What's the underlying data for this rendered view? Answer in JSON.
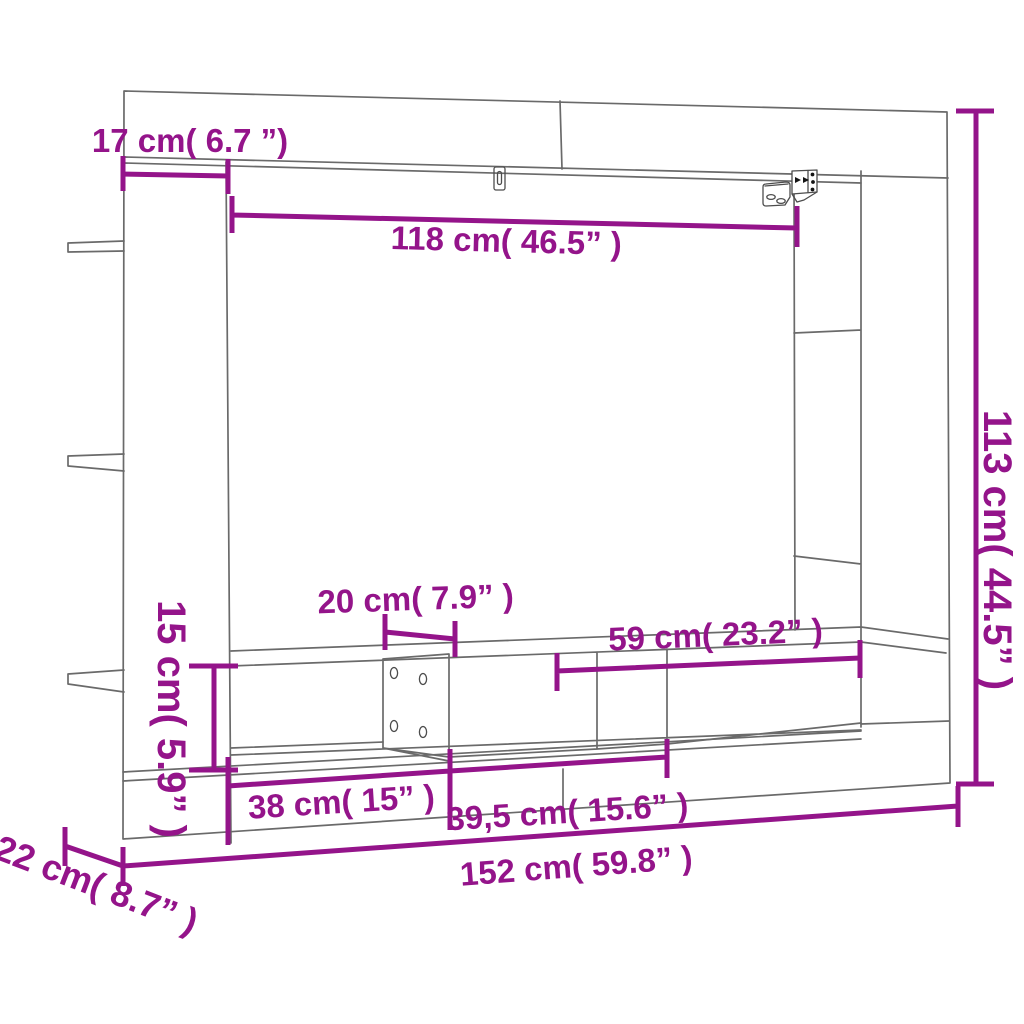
{
  "diagram": {
    "type": "furniture-dimension-drawing",
    "subject": "wall-mounted TV cabinet line drawing with dimension callouts",
    "colors": {
      "dimension": "#94148a",
      "lines": "#6a6a6a",
      "background": "#ffffff"
    },
    "dimensions": {
      "top_shelf_depth": {
        "label": "17 cm( 6.7 ”)"
      },
      "tv_niche_width": {
        "label": "118 cm( 46.5” )"
      },
      "overall_height": {
        "label": "113 cm( 44.5” )"
      },
      "center_support_width": {
        "label": "20 cm( 7.9” )"
      },
      "right_niche_width": {
        "label": "59 cm( 23.2” )"
      },
      "shelf_row_height": {
        "label": "15 cm( 5.9” )"
      },
      "left_compartment_width": {
        "label": "38 cm( 15” )"
      },
      "middle_compartment_width": {
        "label": "39,5 cm( 15.6” )"
      },
      "overall_width": {
        "label": "152 cm( 59.8” )"
      },
      "overall_depth": {
        "label": "22 cm( 8.7” )"
      }
    }
  }
}
